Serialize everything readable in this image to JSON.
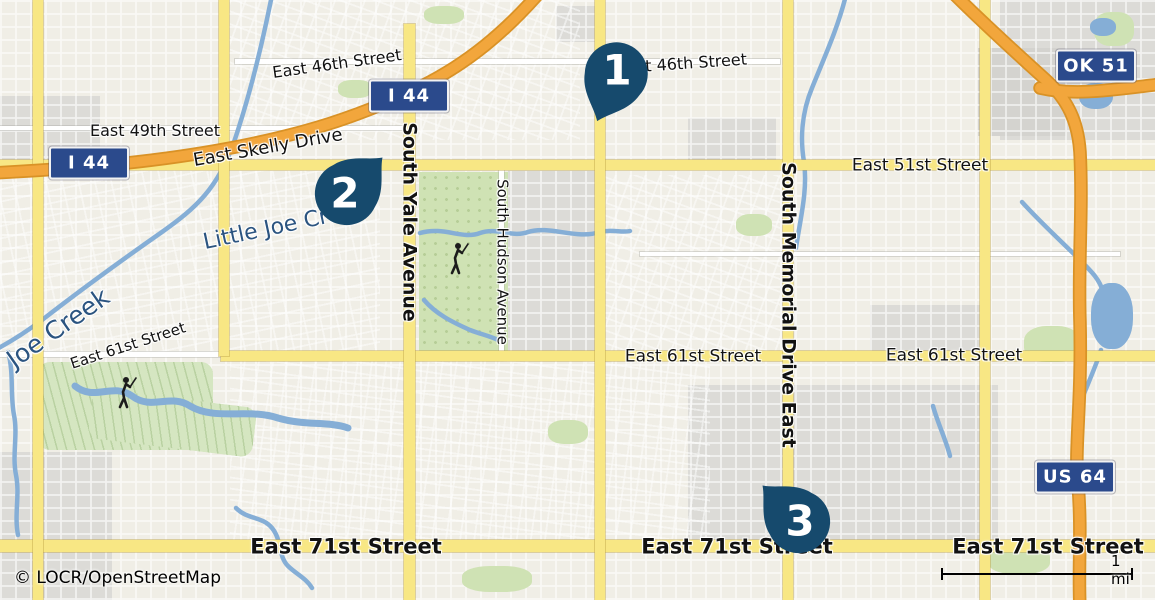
{
  "attribution": {
    "text": "© LOCR/OpenStreetMap"
  },
  "scale_bar": {
    "label": "1 mi"
  },
  "colors": {
    "background": "#f0eee6",
    "district_gray": "#dcdbd7",
    "road_yellow": "#f8e784",
    "road_orange": "#f2a63c",
    "water": "#85aed6",
    "water_label": "#2b5480",
    "park": "#cfe2b4",
    "marker": "#164a6d",
    "shield_bg": "#2b4a8c",
    "shield_text": "#ffffff",
    "label_text": "#121212"
  },
  "markers": [
    {
      "number": "1",
      "cx": 617,
      "cy": 72,
      "tail_angle": 22
    },
    {
      "number": "2",
      "cx": 345,
      "cy": 195,
      "tail_angle": -135
    },
    {
      "number": "3",
      "cx": 800,
      "cy": 523,
      "tail_angle": 135
    }
  ],
  "route_shields": [
    {
      "text": "I 44",
      "cx": 89,
      "cy": 163
    },
    {
      "text": "I 44",
      "cx": 409,
      "cy": 96
    },
    {
      "text": "OK 51",
      "cx": 1096,
      "cy": 66
    },
    {
      "text": "US 64",
      "cx": 1075,
      "cy": 477
    }
  ],
  "street_labels": [
    {
      "text": "East 46th Street",
      "x": 337,
      "y": 64,
      "rot": -8,
      "size": 16,
      "weight": 400,
      "kind": "street"
    },
    {
      "text": "East 46th Street",
      "x": 682,
      "y": 64,
      "rot": -4,
      "size": 16,
      "weight": 400,
      "kind": "street"
    },
    {
      "text": "East 49th Street",
      "x": 155,
      "y": 131,
      "rot": 0,
      "size": 16,
      "weight": 400,
      "kind": "street"
    },
    {
      "text": "East Skelly Drive",
      "x": 268,
      "y": 148,
      "rot": -10,
      "size": 18,
      "weight": 400,
      "kind": "street"
    },
    {
      "text": "East 51st Street",
      "x": 920,
      "y": 166,
      "rot": 0,
      "size": 17,
      "weight": 400,
      "kind": "street"
    },
    {
      "text": "East 61st Street",
      "x": 128,
      "y": 346,
      "rot": -18,
      "size": 15,
      "weight": 400,
      "kind": "street"
    },
    {
      "text": "East 61st Street",
      "x": 693,
      "y": 357,
      "rot": 0,
      "size": 17,
      "weight": 400,
      "kind": "street"
    },
    {
      "text": "East 61st Street",
      "x": 954,
      "y": 356,
      "rot": 0,
      "size": 17,
      "weight": 400,
      "kind": "street"
    },
    {
      "text": "East 71st Street",
      "x": 346,
      "y": 547,
      "rot": 0,
      "size": 21,
      "weight": 700,
      "kind": "street"
    },
    {
      "text": "East 71st Street",
      "x": 737,
      "y": 547,
      "rot": 0,
      "size": 21,
      "weight": 700,
      "kind": "street"
    },
    {
      "text": "East 71st Street",
      "x": 1048,
      "y": 547,
      "rot": 0,
      "size": 21,
      "weight": 700,
      "kind": "street"
    },
    {
      "text": "South Yale Avenue",
      "x": 409,
      "y": 222,
      "rot": 90,
      "size": 19,
      "weight": 700,
      "kind": "street"
    },
    {
      "text": "South Hudson Avenue",
      "x": 502,
      "y": 262,
      "rot": 90,
      "size": 15,
      "weight": 400,
      "kind": "street"
    },
    {
      "text": "South Memorial Drive East",
      "x": 788,
      "y": 305,
      "rot": 90,
      "size": 19,
      "weight": 700,
      "kind": "street"
    },
    {
      "text": "Little Joe Creek",
      "x": 285,
      "y": 226,
      "rot": -12,
      "size": 22,
      "weight": 400,
      "kind": "water"
    },
    {
      "text": "Joe Creek",
      "x": 58,
      "y": 328,
      "rot": -35,
      "size": 25,
      "weight": 400,
      "kind": "water"
    }
  ]
}
